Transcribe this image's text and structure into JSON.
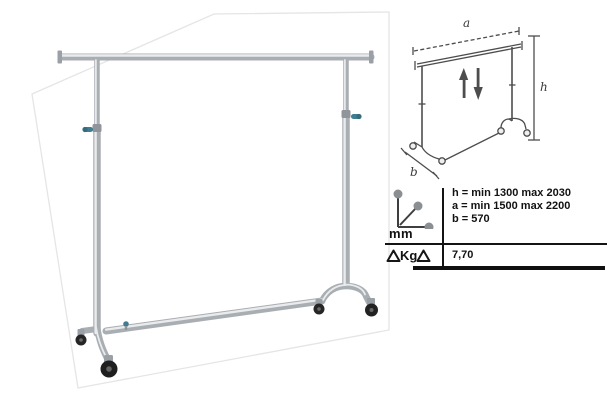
{
  "diagram": {
    "width_label": "a",
    "height_label": "h",
    "depth_label": "b"
  },
  "specs": {
    "dimensions_unit": "mm",
    "lines": [
      "h = min 1300 max 2030",
      "a = min 1500 max 2200",
      "b = 570"
    ],
    "weight_unit": "Kg",
    "weight_value": "7,70"
  },
  "colors": {
    "chrome_tube": "#a9aeb3",
    "chrome_highlight": "#e9ebec",
    "adjust_screw_teal": "#3f7e90",
    "diagram_line": "#4d4d4d",
    "panel_line": "#141414",
    "text": "#121212"
  }
}
